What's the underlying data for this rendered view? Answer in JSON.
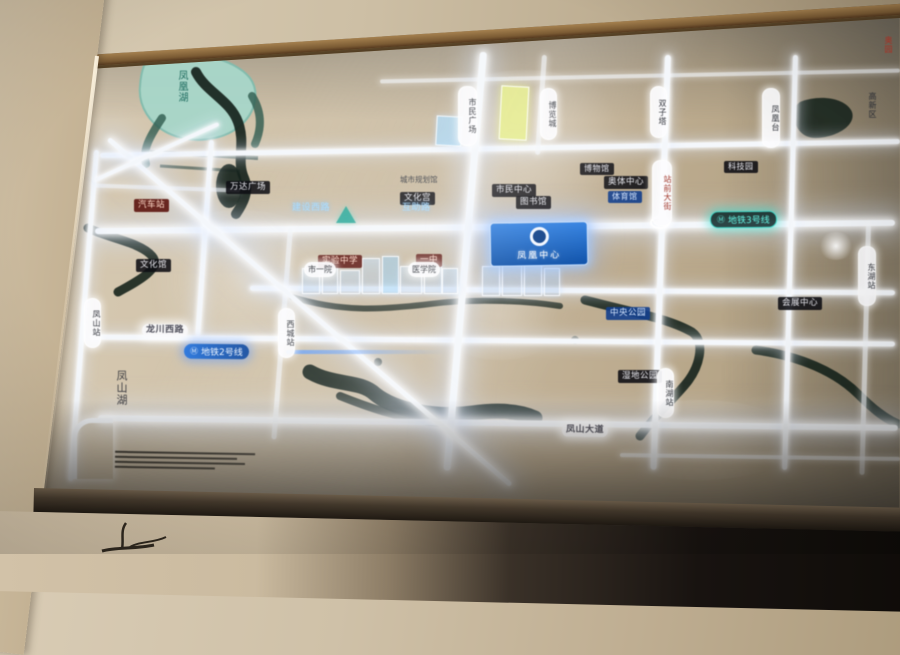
{
  "map": {
    "project_badge": {
      "name": "凤凰中心"
    },
    "metro": {
      "icon": "Ⓜ",
      "line2": "地铁2号线",
      "line3": "地铁3号线"
    },
    "lakes": {
      "top_lake": "凤凰湖",
      "left_lake": "凤山湖"
    },
    "roads": {
      "left_road": "龙川西路",
      "bottom_road": "凤山大道",
      "blue1": "建设西路",
      "blue2": "互助路",
      "vertical_red": "站前大街"
    },
    "badges": {
      "wanda": "万达广场",
      "museum": "博物馆",
      "civic": "市民中心",
      "aoti": "奥体中心",
      "gym": "体育馆",
      "school": "实验中学",
      "no1": "一中",
      "library": "图书馆",
      "culture_palace": "文化宫",
      "central_park": "中央公园",
      "wetland": "湿地公园",
      "exhibition": "会展中心",
      "bus": "汽车站",
      "culture_hall": "文化馆",
      "tech": "科技园",
      "planning": "城市规划馆",
      "hightech": "高新区",
      "red_corner": "奥园"
    },
    "stations": {
      "s1": "市民广场",
      "s2": "博览城",
      "s3": "双子塔",
      "s4": "凤凰台",
      "s5": "东湖站",
      "s6": "南湖站",
      "s7": "凤山站",
      "s8": "西城站",
      "h1": "市一院",
      "h2": "医学院"
    },
    "colors": {
      "road_glow": "#f4f7fb",
      "metro2": "#2a6fd0",
      "metro3": "#3fd8c8",
      "river": "#16231c",
      "lake": "#a7d6c9",
      "badge_blue": "#1763c5"
    }
  }
}
